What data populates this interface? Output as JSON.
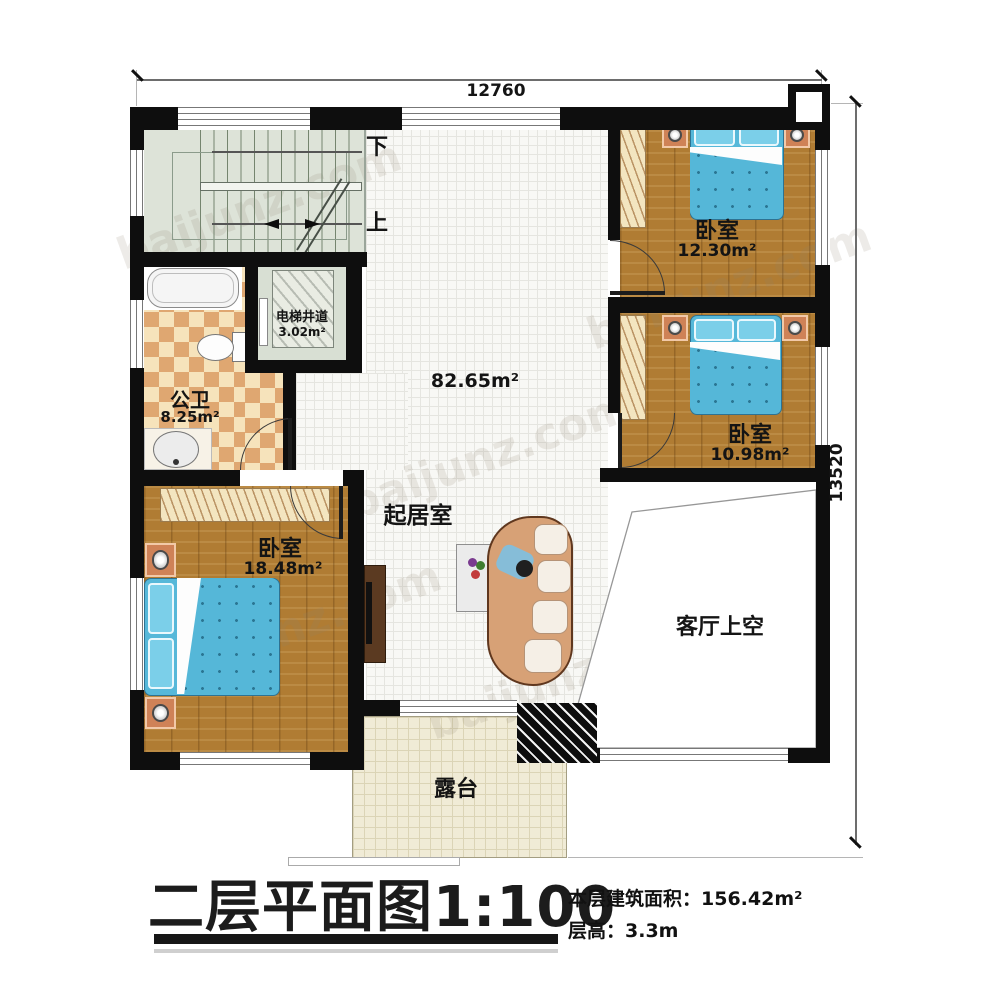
{
  "floor_plan": {
    "dim_top": "12760",
    "dim_right": "13520",
    "stair_down": "下",
    "stair_up": "上",
    "rooms": {
      "living": {
        "name": "起居室",
        "area": "82.65m²"
      },
      "bedroom_tr": {
        "name": "卧室",
        "area": "12.30m²"
      },
      "bedroom_mr": {
        "name": "卧室",
        "area": "10.98m²"
      },
      "bedroom_bl": {
        "name": "卧室",
        "area": "18.48m²"
      },
      "bathroom": {
        "name": "公卫",
        "area": "8.25m²"
      },
      "elevator": {
        "name": "电梯井道",
        "area": "3.02m²"
      },
      "void_above_living": {
        "name": "客厅上空"
      },
      "terrace": {
        "name": "露台"
      }
    }
  },
  "title_block": {
    "title": "二层平面图",
    "scale": "1:100",
    "floor_area_label": "本层建筑面积：",
    "floor_area_value": "156.42m²",
    "floor_height_label": "层高：",
    "floor_height_value": "3.3m"
  },
  "watermark": {
    "text": "baijunz.com"
  }
}
